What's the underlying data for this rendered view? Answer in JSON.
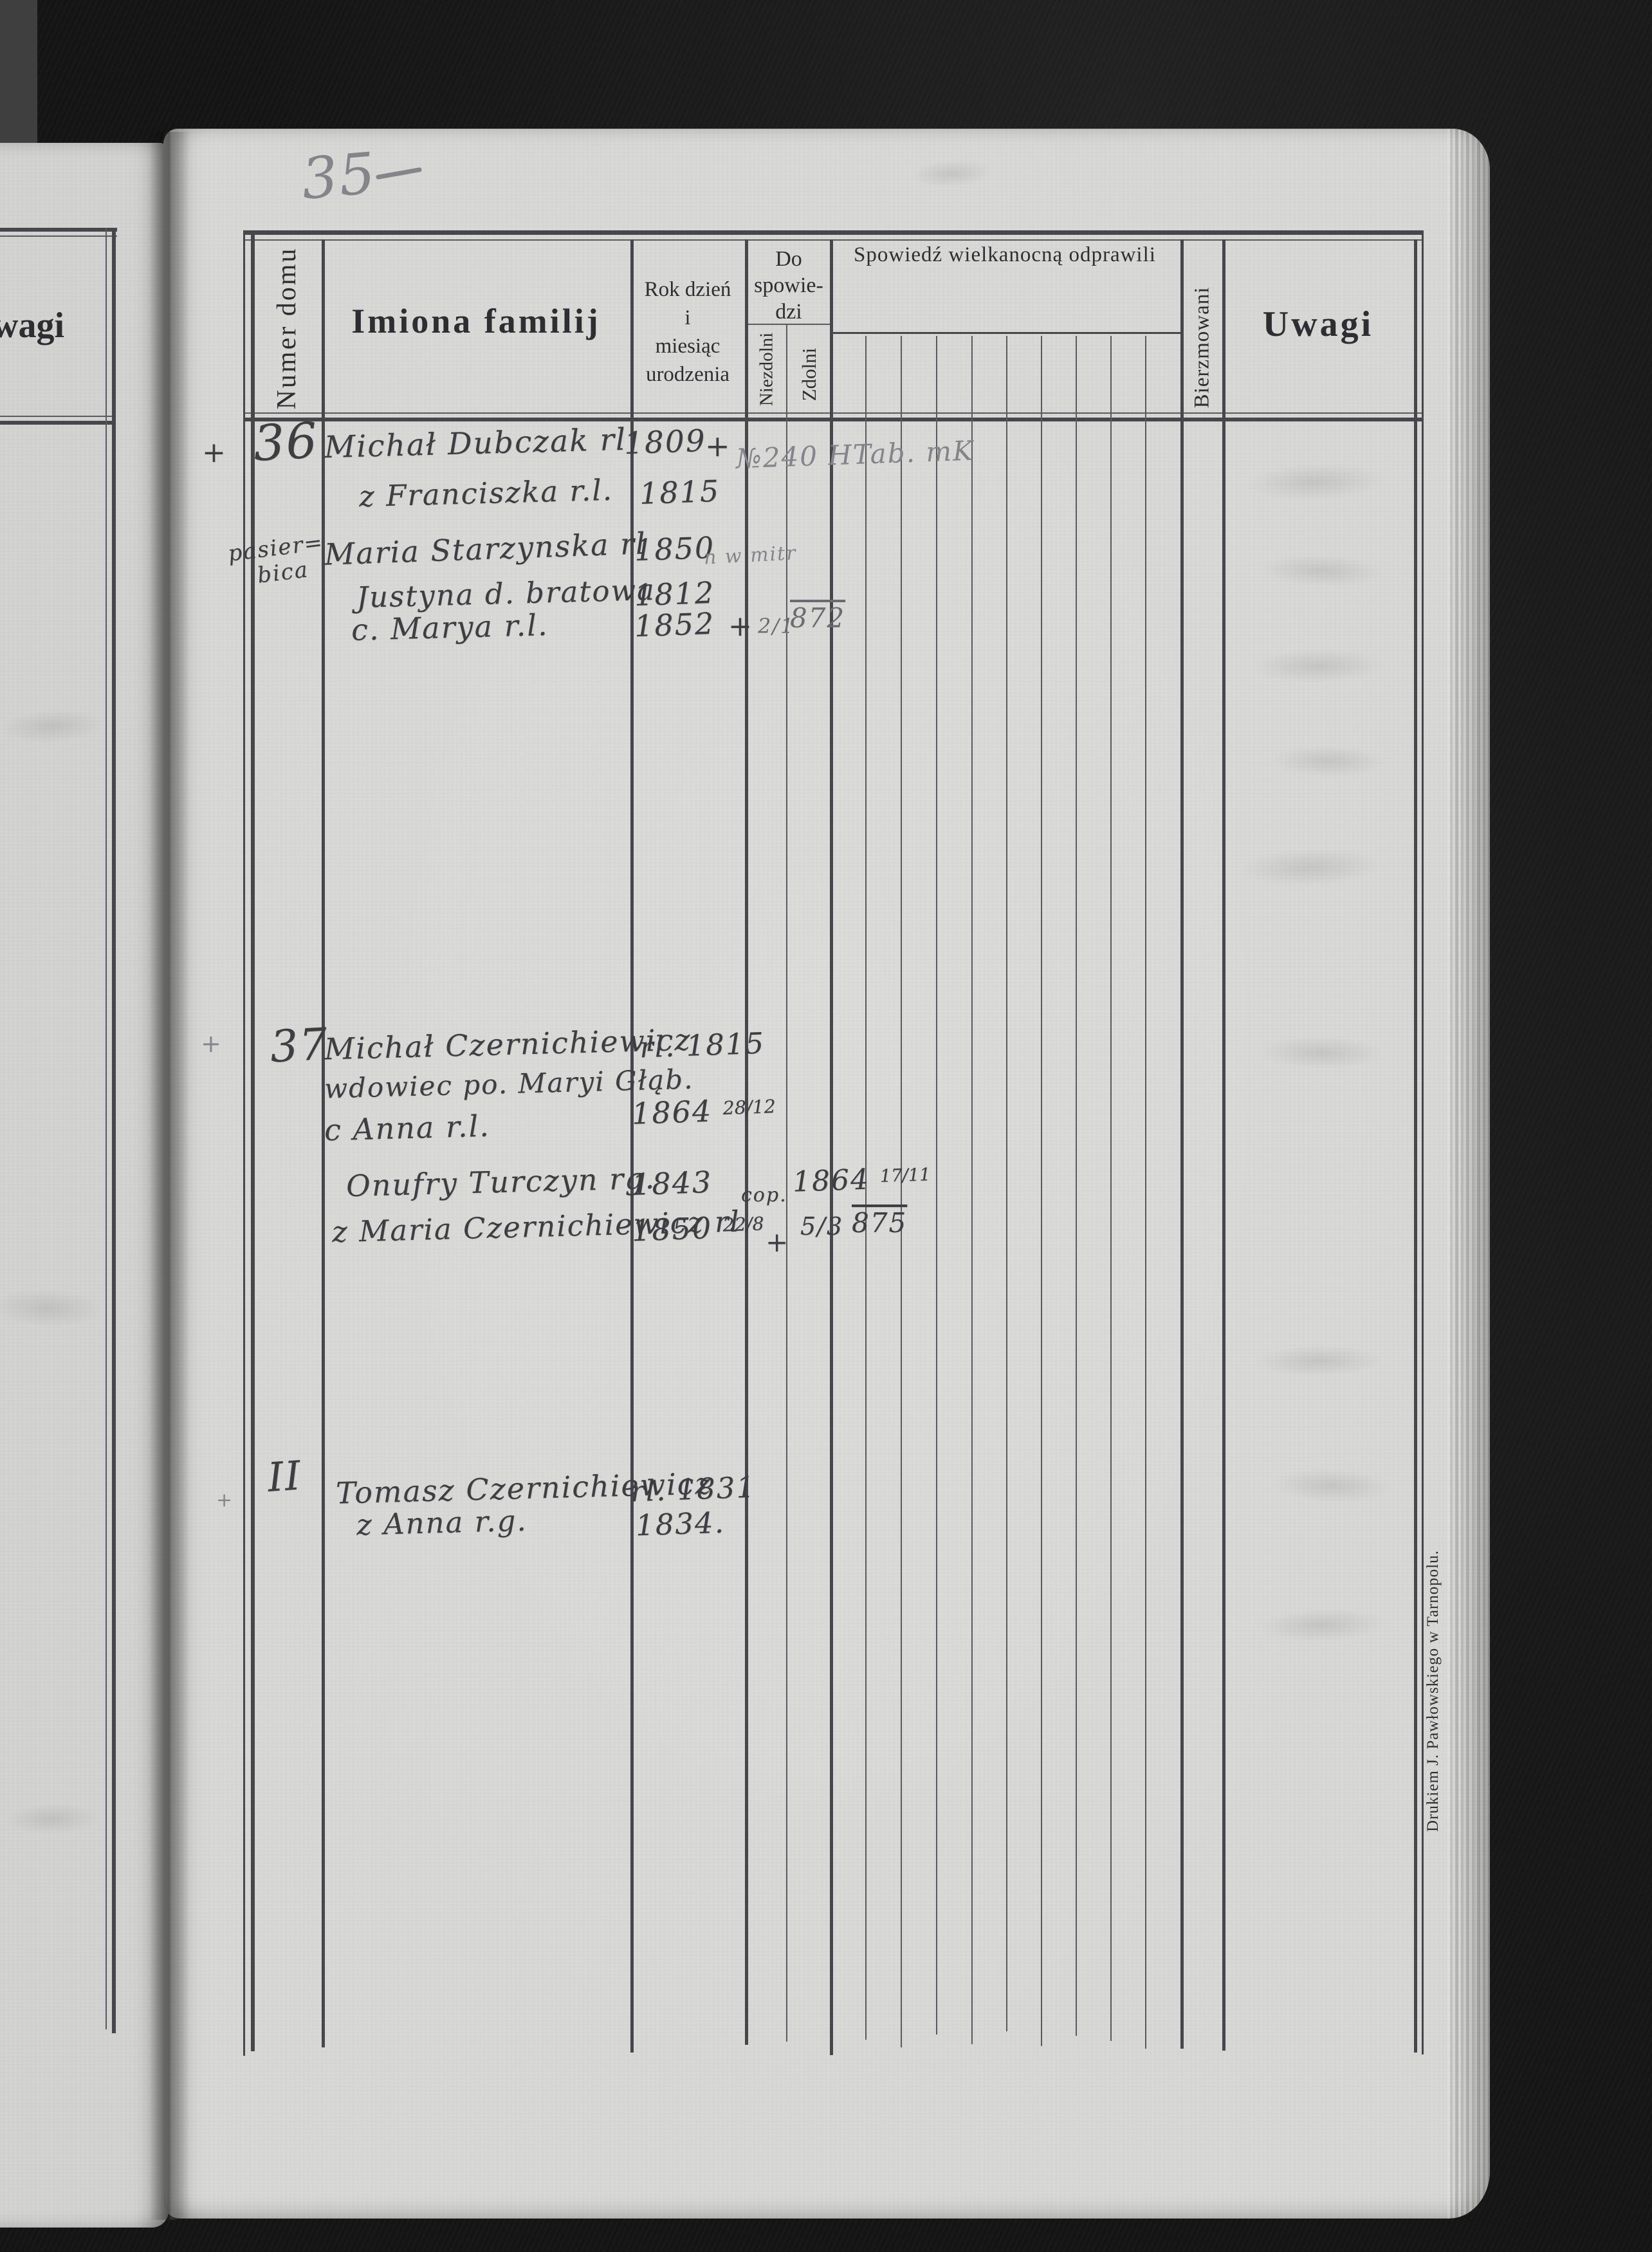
{
  "page_number": "35",
  "prev_page": {
    "uwagi_partial": "wagi"
  },
  "header": {
    "numer_domu": "Numer domu",
    "imiona_familij": "Imiona familij",
    "rok_line1": "Rok dzień",
    "rok_line2": "i",
    "rok_line3": "miesiąc",
    "rok_line4": "urodzenia",
    "do_line1": "Do",
    "do_line2": "spowie-",
    "do_line3": "dzi",
    "niezdolni": "Niezdolni",
    "zdolni": "Zdolni",
    "spowiedz": "Spowiedź wielkanocną odprawili",
    "bierzmowani": "Bierzmowani",
    "uwagi": "Uwagi"
  },
  "records": {
    "r36": {
      "margin_cross": "+",
      "house_no": "36",
      "side_note_1": "pasier=",
      "side_note_2": "bica",
      "l1_name": "Michał Dubczak rl",
      "l1_year": "1809",
      "l1_cross": "+",
      "l1_pencil": "№240 HTab. mK",
      "l2_name": "z Franciszka r.l.",
      "l2_year": "1815",
      "l3_name": "Maria Starzynska rl",
      "l3_year": "1850",
      "l3_pencil": "n w mitr",
      "l4_name": "Justyna d. bratowa",
      "l4_year": "1812",
      "l5_name": "c. Marya r.l.",
      "l5_year": "1852",
      "l5_cross": "+",
      "l5_death_day": "2/1",
      "l5_death_year": "872"
    },
    "r37": {
      "margin_cross": "+",
      "house_no": "37",
      "l1_name": "Michał Czernichiewicz",
      "l1_year": "rl. 1815",
      "l2_name": "wdowiec po. Maryi Głąb.",
      "l3_name": "c Anna r.l.",
      "l3_year": "1864",
      "l3_frac": "28/12",
      "l4_name": "Onufry Turczyn rg.",
      "l4_year": "1843",
      "l4_cop": "cop.",
      "l4_cop_year": "1864",
      "l4_cop_frac": "17/11",
      "l5_name": "z Maria Czernichiewicz rl",
      "l5_year": "1850",
      "l5_frac": "22/8",
      "l5_cross": "+",
      "l5_death_day": "5/3",
      "l5_death_year": "875"
    },
    "rII": {
      "house_no": "II",
      "margin_cross": "+",
      "l1_name": "Tomasz Czernichiewicz",
      "l1_year": "rl. 1831",
      "l2_name": "z Anna r.g.",
      "l2_year": "1834."
    }
  },
  "footer": {
    "printer": "Drukiem J. Pawłowskiego w Tarnopolu."
  }
}
